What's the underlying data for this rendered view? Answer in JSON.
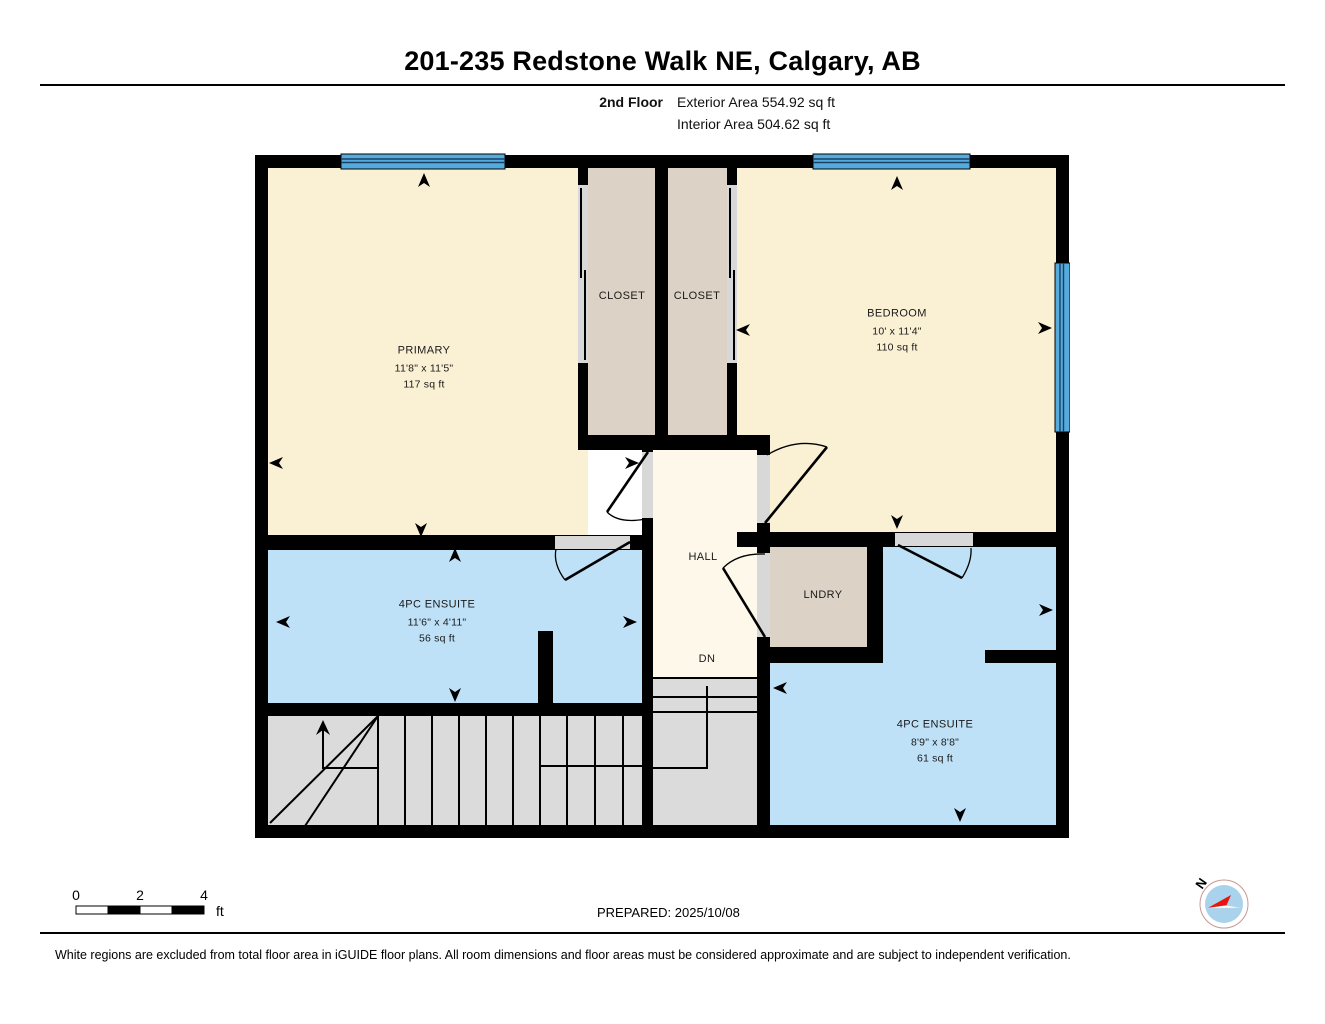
{
  "header": {
    "title": "201-235 Redstone Walk NE, Calgary, AB",
    "floor_label": "2nd Floor",
    "exterior_area": "Exterior Area 554.92 sq ft",
    "interior_area": "Interior Area 504.62 sq ft"
  },
  "rooms": {
    "primary": {
      "name": "PRIMARY",
      "dims": "11'8\" x 11'5\"",
      "area": "117 sq ft"
    },
    "closet1": {
      "name": "CLOSET"
    },
    "closet2": {
      "name": "CLOSET"
    },
    "bedroom": {
      "name": "BEDROOM",
      "dims": "10' x 11'4\"",
      "area": "110 sq ft"
    },
    "ensuite_left": {
      "name": "4PC ENSUITE",
      "dims": "11'6\" x 4'11\"",
      "area": "56 sq ft"
    },
    "ensuite_right": {
      "name": "4PC ENSUITE",
      "dims": "8'9\" x 8'8\"",
      "area": "61 sq ft"
    },
    "hall": {
      "name": "HALL"
    },
    "laundry": {
      "name": "LNDRY"
    },
    "stairs_down": {
      "name": "DN"
    }
  },
  "scale_bar": {
    "tick0": "0",
    "tick2": "2",
    "tick4": "4",
    "unit": "ft"
  },
  "compass": {
    "north_label": "N"
  },
  "footer": {
    "prepared": "PREPARED: 2025/10/08",
    "disclaimer": "White regions are excluded from total floor area in iGUIDE floor plans. All room dimensions and floor areas must be considered approximate and are subject to independent verification."
  },
  "colors": {
    "room_cream": "#FAF0D4",
    "hall_cream": "#FDF8E9",
    "closet_tan": "#DCD3C6",
    "ensuite_blue": "#BEE1F7",
    "window_blue": "#55ABDB",
    "stairs_gray": "#DBDBDB",
    "door_gray": "#D8D8D8",
    "wall_black": "#000000",
    "compass_blue": "#A9D2EC",
    "compass_red": "#E8150E"
  }
}
